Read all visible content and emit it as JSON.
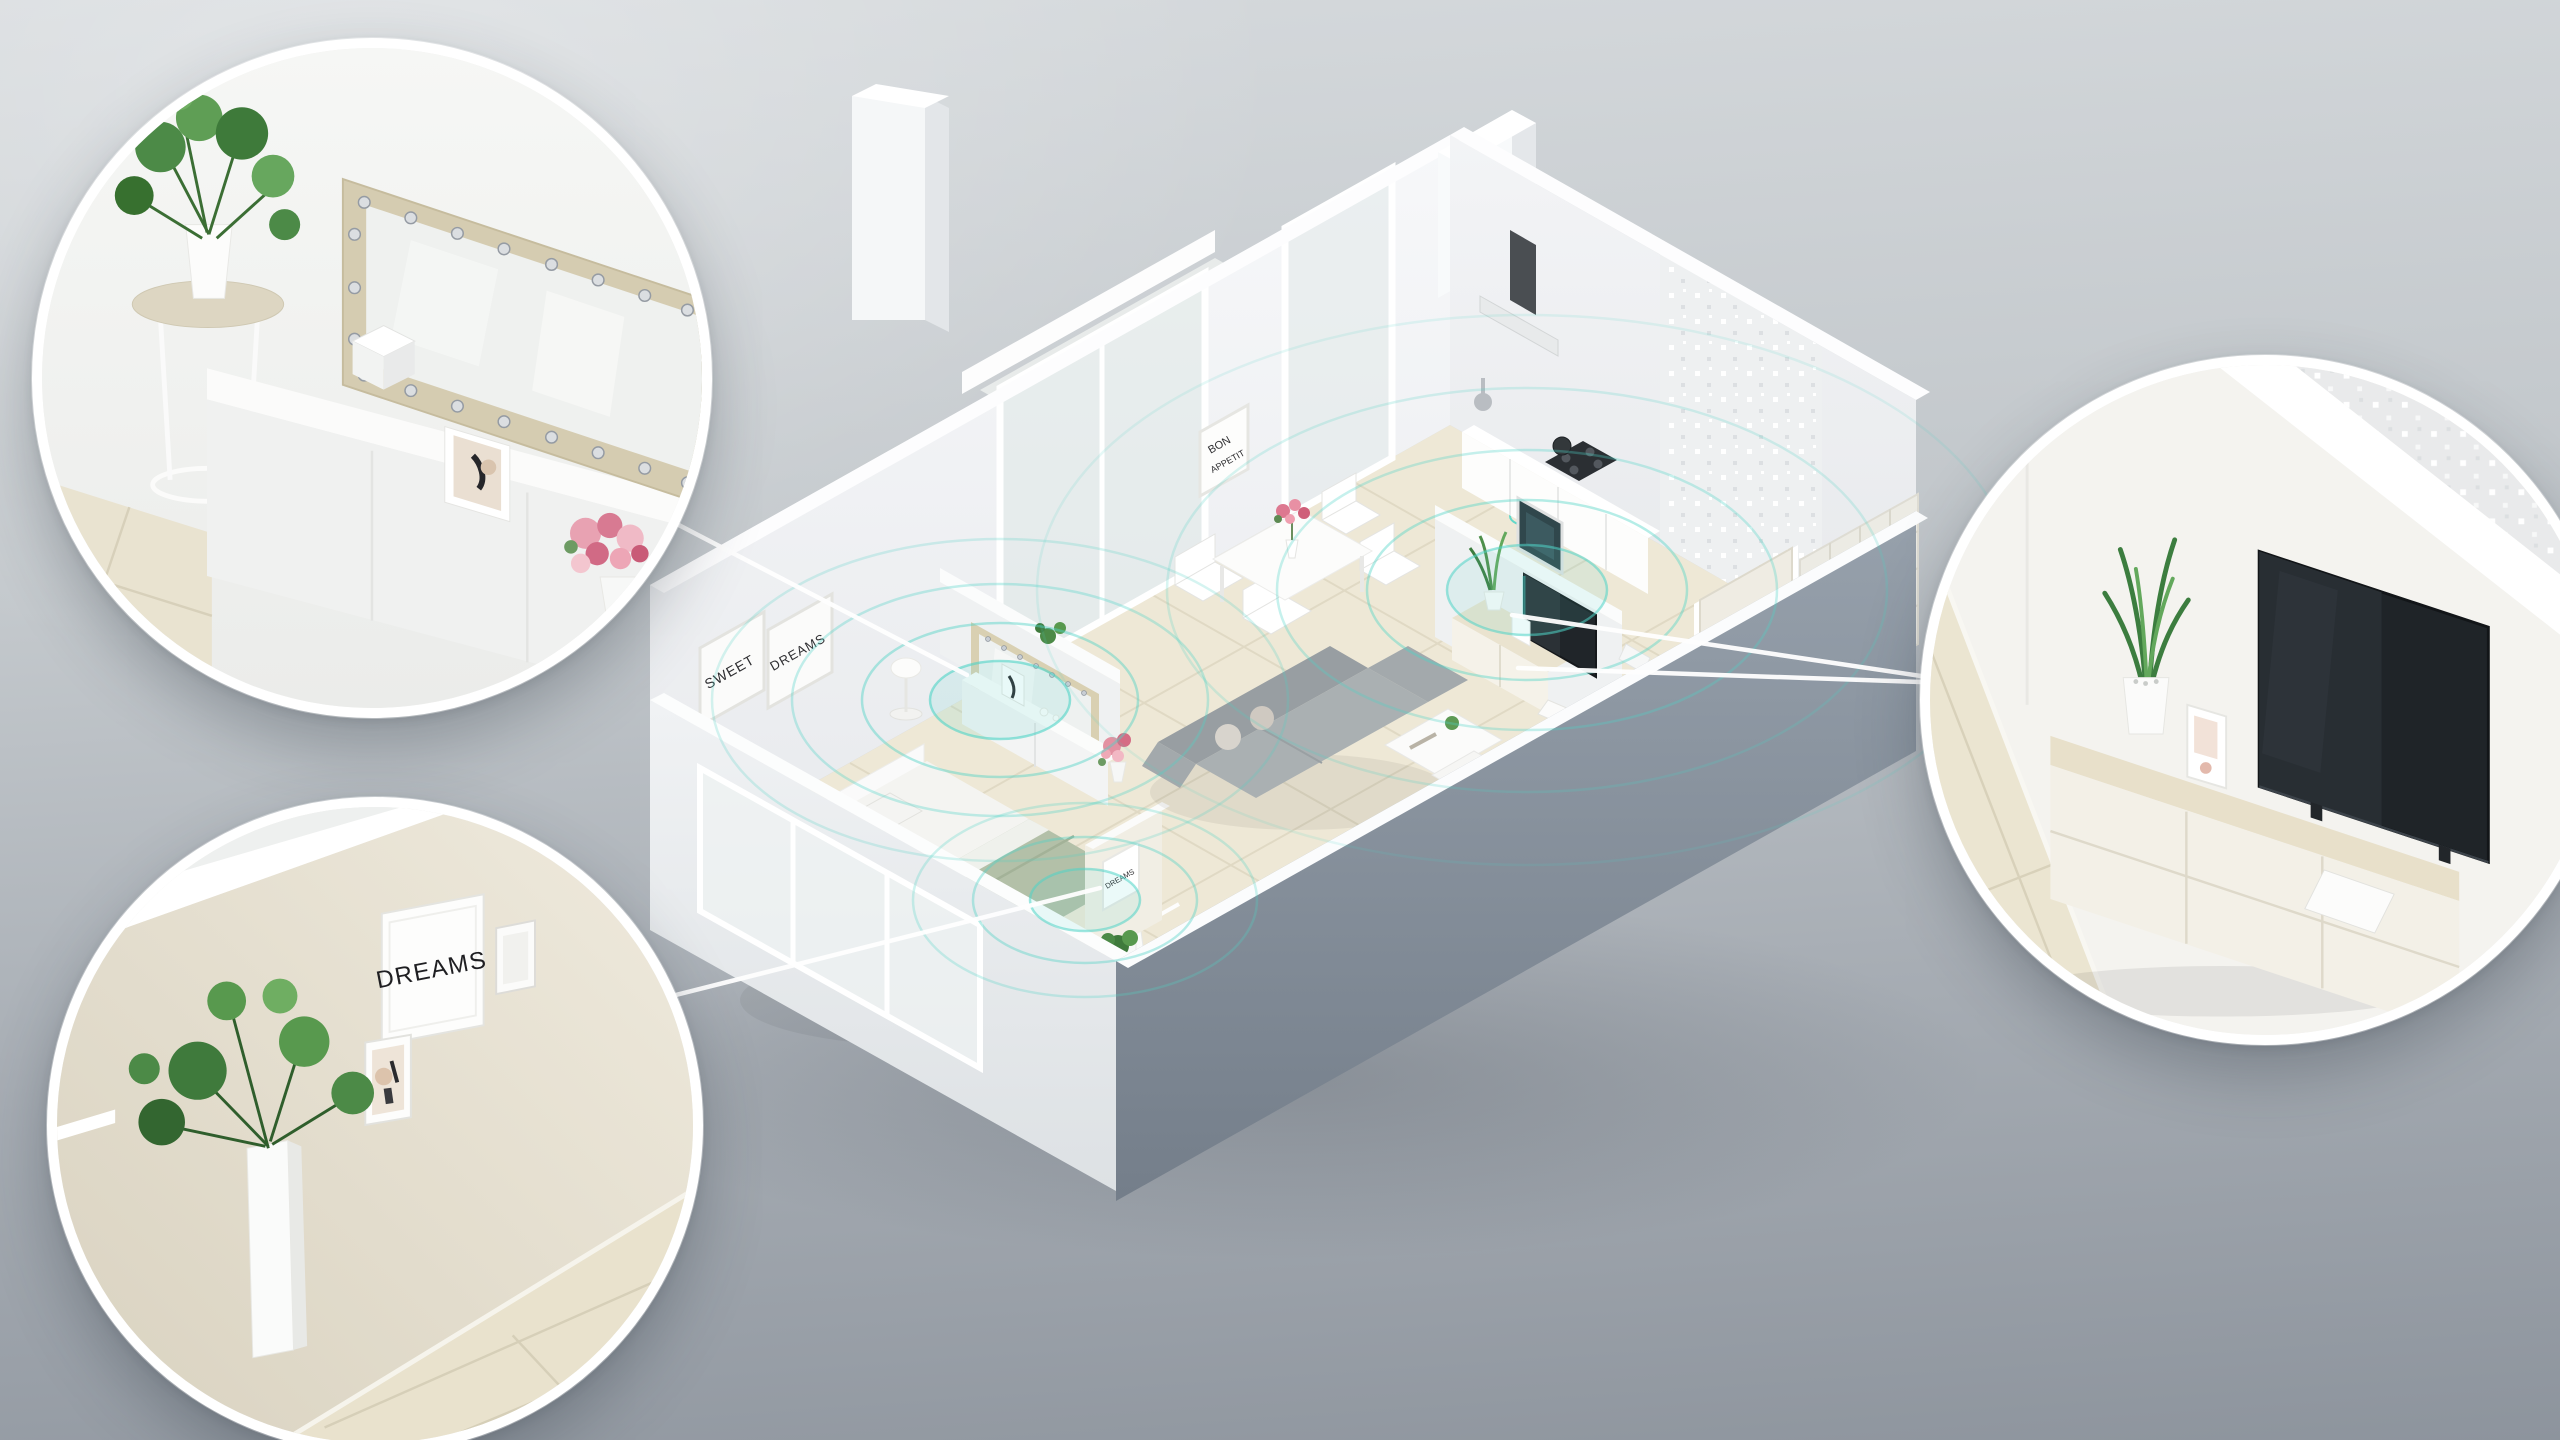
{
  "scene": {
    "description": "Isometric 3D cutaway of a one-bedroom apartment showing teal wireless signal coverage rippling through the rooms, with three magnified circular callouts connected by white lines",
    "colors": {
      "background_top": "#d5d9dc",
      "background_bottom": "#8f969e",
      "accent_teal": "#4fd3c6",
      "floor_cream": "#eee8d6",
      "wall_white": "#f4f5f7",
      "wall_dark": "#8b95a1",
      "blanket_sage": "#b3c0a8",
      "sofa_gray": "#a6acaf",
      "wood_beige": "#ddd2b6"
    }
  },
  "apartment": {
    "posters": {
      "bedroom_left": "SWEET",
      "bedroom_right": "DREAMS",
      "dining_line1": "BON",
      "dining_line2": "APPETIT",
      "hallway": "DREAMS"
    },
    "rooms": [
      "bedroom",
      "walk-in closet",
      "hallway",
      "living room",
      "dining area",
      "kitchen",
      "bathroom",
      "laundry",
      "balcony",
      "entry"
    ],
    "signal_sources": [
      "vanity mirror dresser",
      "living room speaker",
      "hallway"
    ]
  },
  "callouts": {
    "vanity": {
      "id": "bedroom-vanity-mirror-zoom",
      "description": "sideboard with bulb-studded vanity mirror, plant stand and flower bouquet"
    },
    "dreams_wall": {
      "id": "closet-dreams-wall-zoom",
      "poster_text": "DREAMS",
      "description": "gallery wall with DREAMS print, small frames, monstera planter and clothes rail"
    },
    "tv": {
      "id": "living-room-tv-zoom",
      "description": "TV sideboard with snake plant, print card, book and wall TV"
    }
  }
}
